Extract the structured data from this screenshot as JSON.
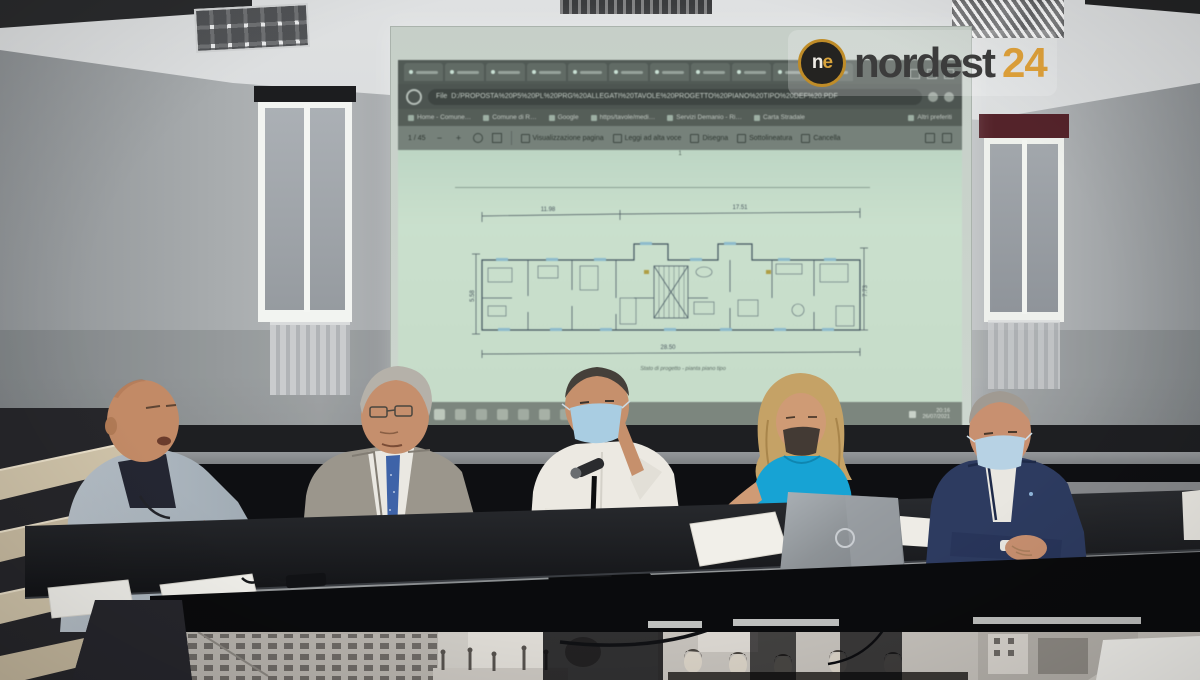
{
  "scene": {
    "alt": "Press conference: five panelists seated at a dark table in an auditorium; a projection screen shows a browser PDF with an apartment floor plan; nordest24 watermark top right."
  },
  "logo": {
    "icon_n": "n",
    "icon_e": "e",
    "word": "nordest",
    "number": "24"
  },
  "colors": {
    "logo_orange": "#dfa13a",
    "screen_mint": "#cbe3cf",
    "mask_blue": "#a9cde2",
    "woman_top_turquoise": "#17a3d4",
    "table_dark": "#121316",
    "valance_red": "#54232a"
  },
  "screen": {
    "browser": {
      "address_prefix": "File",
      "address_path": "D:/PROPOSTA%20P5%20PL%20PRG%20ALLEGATI%20TAVOLE%20PROGETTO%20PIANO%20TIPO%20DEF%20.PDF",
      "bookmarks": [
        {
          "label": "Home - Comune…"
        },
        {
          "label": "Comune di R…"
        },
        {
          "label": "Google"
        },
        {
          "label": "https/tavole/medi…"
        },
        {
          "label": "Servizi Demanio - Ri…"
        },
        {
          "label": "Carta Stradale"
        },
        {
          "label": "Altri preferiti"
        }
      ]
    },
    "pdf_toolbar": {
      "page_indicator": "1 / 45",
      "zoom_out": "−",
      "zoom_in": "+",
      "buttons": [
        {
          "label": "Visualizzazione pagina"
        },
        {
          "label": "Leggi ad alta voce"
        },
        {
          "label": "Disegna"
        },
        {
          "label": "Sottolineatura"
        },
        {
          "label": "Cancella"
        }
      ]
    },
    "document": {
      "page_marker": "1",
      "caption": "Stato di progetto - pianta piano tipo",
      "plan_dims": {
        "top_left": "11.98",
        "top_right": "17.51",
        "left": "5.58",
        "right": "7.73",
        "bottom": "28.50"
      }
    },
    "taskbar": {
      "time": "20:16",
      "date": "26/07/2021"
    }
  }
}
